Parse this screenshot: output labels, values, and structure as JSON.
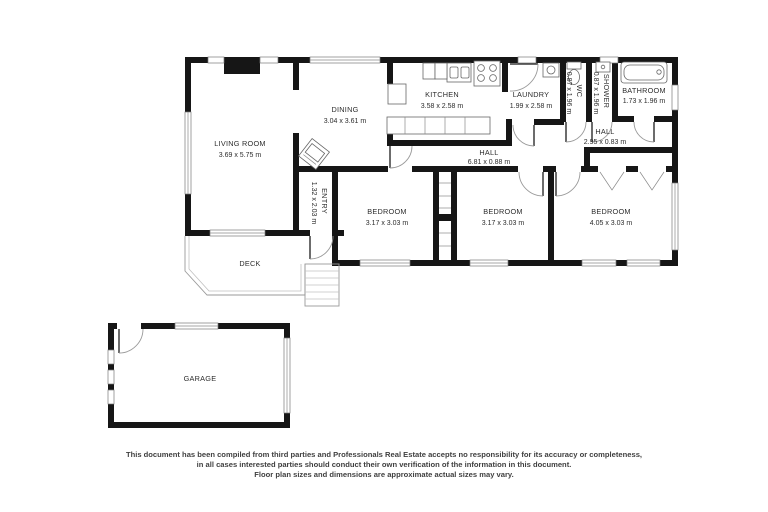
{
  "page": {
    "background": "#ffffff",
    "wall_color": "#161616",
    "text_color": "#2d2d2d"
  },
  "plan": {
    "rooms": {
      "living": {
        "label": "LIVING ROOM",
        "dims": "3.69 x 5.75 m"
      },
      "dining": {
        "label": "DINING",
        "dims": "3.04 x 3.61 m"
      },
      "kitchen": {
        "label": "KITCHEN",
        "dims": "3.58 x 2.58 m"
      },
      "laundry": {
        "label": "LAUNDRY",
        "dims": "1.99 x 2.58 m"
      },
      "wc": {
        "label": "WC",
        "dims": "0.87 x 1.96 m"
      },
      "shower": {
        "label": "SHOWER",
        "dims": "0.87 x 1.96 m"
      },
      "bathroom": {
        "label": "BATHROOM",
        "dims": "1.73 x 1.96 m"
      },
      "hall_rear": {
        "label": "HALL",
        "dims": "2.95 x 0.83 m"
      },
      "hall_main": {
        "label": "HALL",
        "dims": "6.81 x 0.88 m"
      },
      "entry": {
        "label": "ENTRY",
        "dims": "1.32 x 2.03 m"
      },
      "bedroom1": {
        "label": "BEDROOM",
        "dims": "3.17 x 3.03 m"
      },
      "bedroom2": {
        "label": "BEDROOM",
        "dims": "3.17 x 3.03 m"
      },
      "bedroom3": {
        "label": "BEDROOM",
        "dims": "4.05 x 3.03 m"
      },
      "deck": {
        "label": "DECK"
      },
      "garage": {
        "label": "GARAGE"
      }
    }
  },
  "disclaimer": {
    "line1": "This document has been compiled from third parties and Professionals Real Estate accepts no responsibility for its accuracy or completeness,",
    "line2": "in all cases interested parties should conduct their own verification of the information in this document.",
    "line3": "Floor plan sizes and dimensions are approximate actual sizes may vary."
  }
}
